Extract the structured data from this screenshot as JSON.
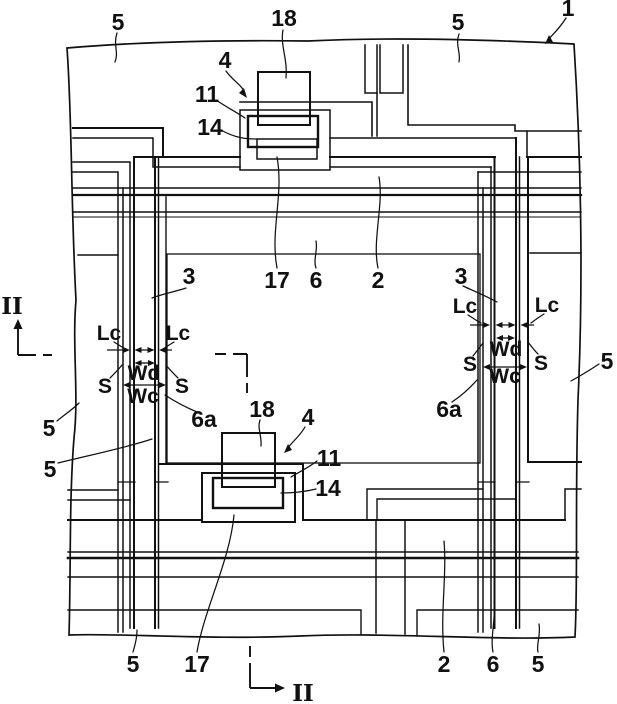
{
  "figure": {
    "background_color": "#ffffff",
    "line_color": "#111111",
    "reference_labels": {
      "five_top_left": "5",
      "eighteen_top": "18",
      "four_top": "4",
      "eleven_top": "11",
      "fourteen_top": "14",
      "five_top_right": "5",
      "one": "1",
      "three_left": "3",
      "six_a_left": "6a",
      "five_left_upper": "5",
      "five_left_lower": "5",
      "seventeen_upper": "17",
      "six_upper": "6",
      "two_upper": "2",
      "three_right": "3",
      "six_a_right": "6a",
      "five_right": "5",
      "eighteen_bottom": "18",
      "four_bottom": "4",
      "eleven_bottom": "11",
      "fourteen_bottom": "14",
      "seventeen_bottom": "17",
      "five_bottom_left": "5",
      "two_bottom": "2",
      "six_bottom": "6",
      "five_bottom_right": "5"
    },
    "dimension_labels": {
      "lc_left_outer": "Lc",
      "lc_left_inner": "Lc",
      "wd_left": "Wd",
      "wc_left": "Wc",
      "s_left_outer": "S",
      "s_left_inner": "S",
      "lc_right_inner": "Lc",
      "lc_right_outer": "Lc",
      "wd_right": "Wd",
      "wc_right": "Wc",
      "s_right_inner": "S",
      "s_right_outer": "S"
    },
    "section_markers": {
      "left": "II",
      "bottom": "II"
    }
  }
}
